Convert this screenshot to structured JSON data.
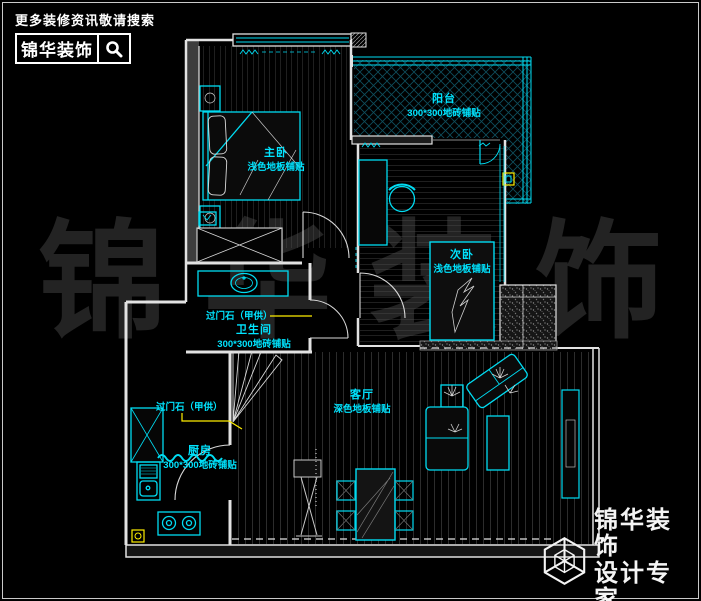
{
  "header": {
    "tagline": "更多装修资讯敬请搜索",
    "brand": "锦华装饰",
    "search_icon": "magnifier"
  },
  "watermark": {
    "chars": [
      "锦",
      "华",
      "装",
      "饰"
    ]
  },
  "rooms": [
    {
      "id": "master-bedroom",
      "name": "主卧",
      "spec": "浅色地板铺贴"
    },
    {
      "id": "balcony",
      "name": "阳台",
      "spec": "300*300地砖铺贴"
    },
    {
      "id": "second-bedroom",
      "name": "次卧",
      "spec": "浅色地板铺贴"
    },
    {
      "id": "bathroom",
      "name": "卫生间",
      "spec": "300*300地砖铺贴"
    },
    {
      "id": "kitchen",
      "name": "厨房",
      "spec": "300*300地砖铺贴"
    },
    {
      "id": "living-room",
      "name": "客厅",
      "spec": "深色地板铺贴"
    }
  ],
  "annotations": {
    "bathroom_threshold": "过门石（甲供）",
    "kitchen_threshold": "过门石（甲供）"
  },
  "footer": {
    "brand": "锦华装饰",
    "subtitle": "设计专家",
    "website": "WWW.JS-JINHUA.COM",
    "logo_icon": "wireframe-cube"
  },
  "colors": {
    "background": "#000000",
    "plan_line": "#00dcf2",
    "leader": "#ffee00",
    "wall": "#e2e2e2",
    "hatch": "#4d4d4d",
    "watermark": "#232323"
  }
}
